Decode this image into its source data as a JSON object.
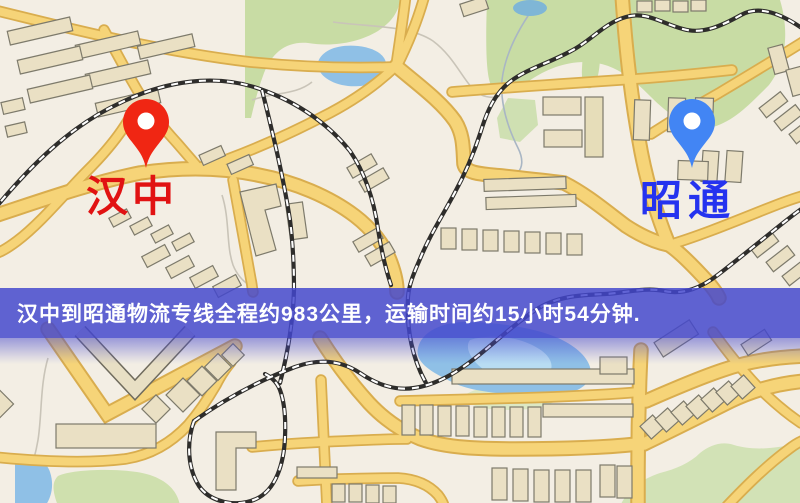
{
  "map": {
    "markers": [
      {
        "id": "origin",
        "label": "汉中",
        "icon": "red-map-pin-icon",
        "pin_color": "#f02613",
        "label_color": "#e11212"
      },
      {
        "id": "destination",
        "label": "昭通",
        "icon": "blue-map-pin-icon",
        "pin_color": "#4285f4",
        "label_color": "#2533ef"
      }
    ]
  },
  "banner": {
    "text": "汉中到昭通物流专线全程约983公里，运输时间约15小时54分钟.",
    "background_color": "#4346cd",
    "text_color": "#ffffff"
  },
  "palette": {
    "map_background": "#f3eee4",
    "road_fill": "#f6d478",
    "road_casing": "#d9ad4e",
    "park_green": "#c8dca4",
    "water_blue": "#8fc0e6",
    "building_fill": "#eae0c4",
    "railway_dark": "#2e2d2b"
  }
}
